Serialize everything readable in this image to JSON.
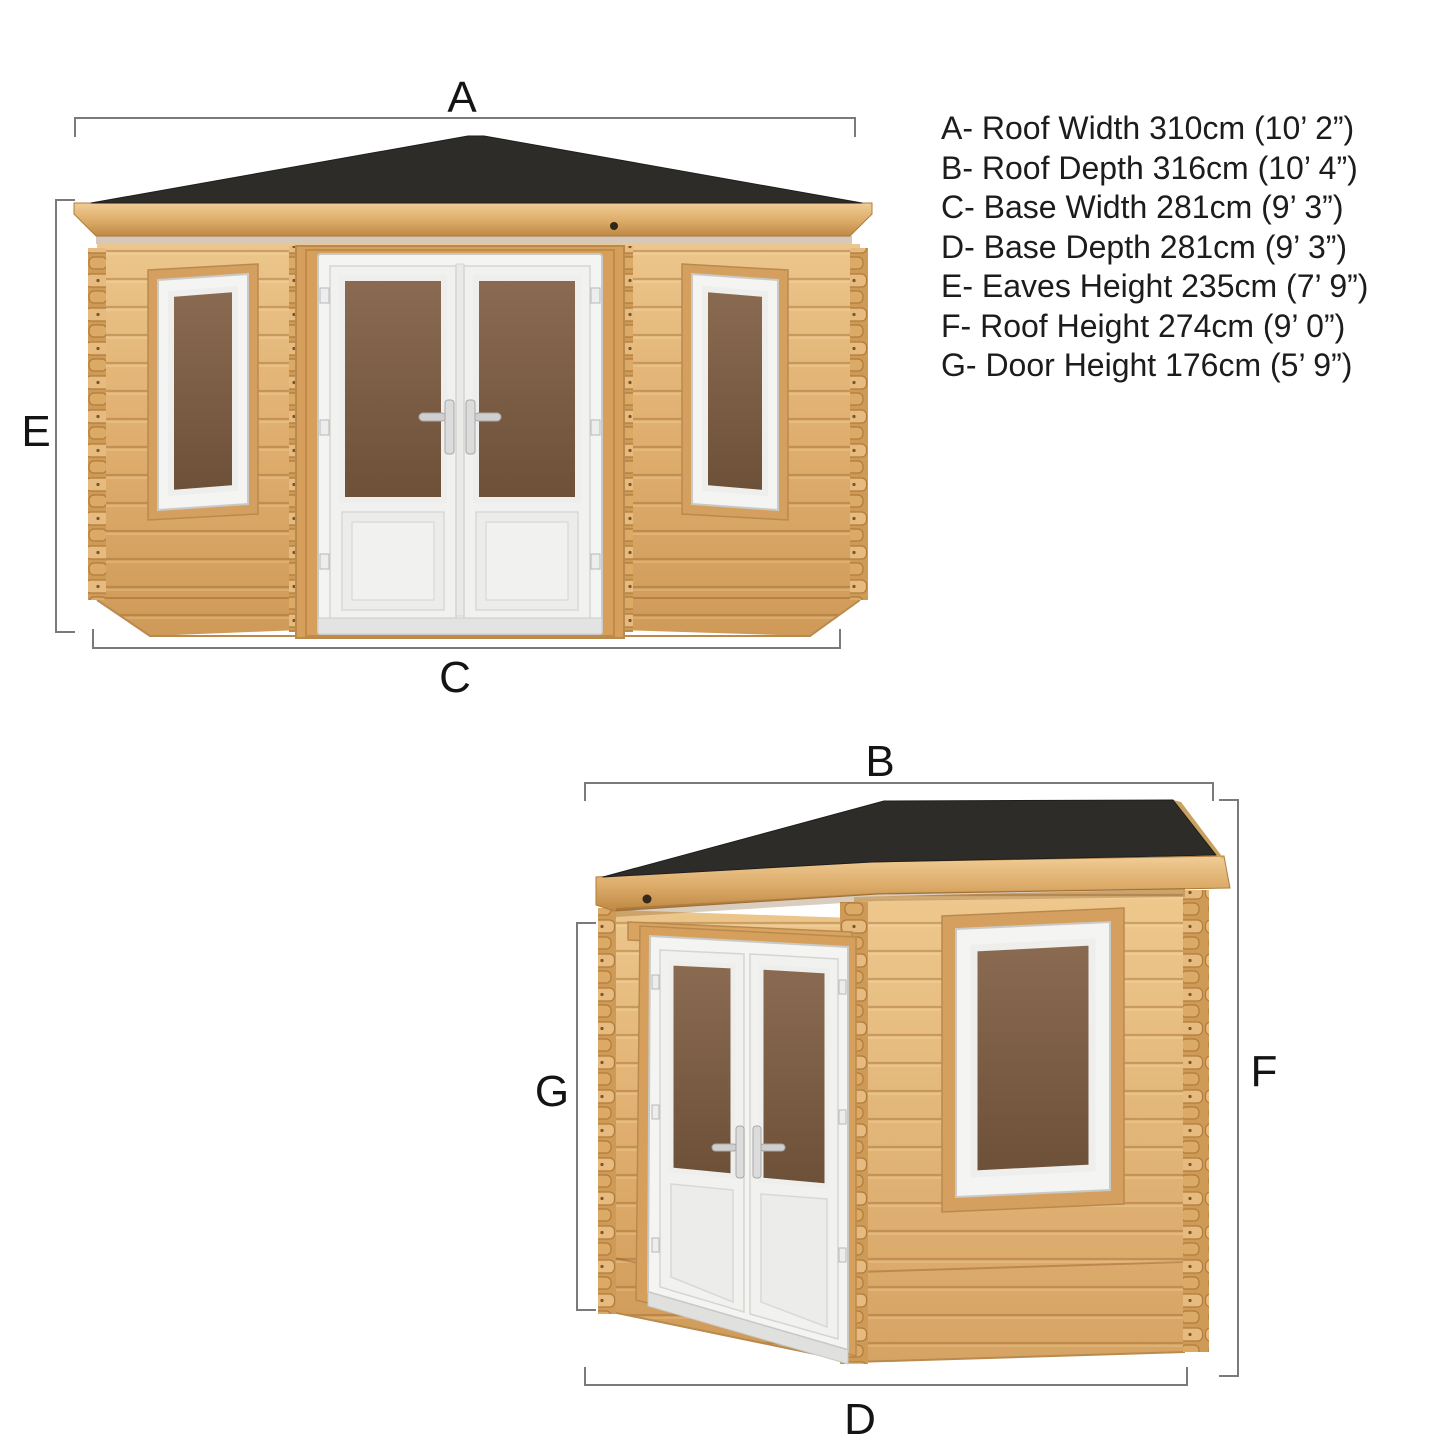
{
  "legend": {
    "items": [
      {
        "text": "A- Roof Width 310cm (10’ 2”)"
      },
      {
        "text": "B- Roof Depth 316cm (10’ 4”)"
      },
      {
        "text": "C- Base Width 281cm (9’ 3”)"
      },
      {
        "text": "D- Base Depth 281cm (9’ 3”)"
      },
      {
        "text": "E- Eaves Height 235cm (7’ 9”)"
      },
      {
        "text": "F- Roof Height 274cm (9’ 0”)"
      },
      {
        "text": "G- Door Height 176cm (5’ 9”)"
      }
    ]
  },
  "dimension_labels": {
    "roof_width": "A",
    "roof_depth": "B",
    "base_width": "C",
    "base_depth": "D",
    "eaves_height": "E",
    "roof_height": "F",
    "door_height": "G"
  },
  "colors": {
    "background": "#ffffff",
    "roof": "#2e2c29",
    "wood_mid": "#dfae6e",
    "wood_dark": "#c08b47",
    "glass_brown": "#7d5f47",
    "frame_white": "#f4f4f2",
    "dimension_line": "#7a7a7a",
    "label_text": "#141414"
  }
}
